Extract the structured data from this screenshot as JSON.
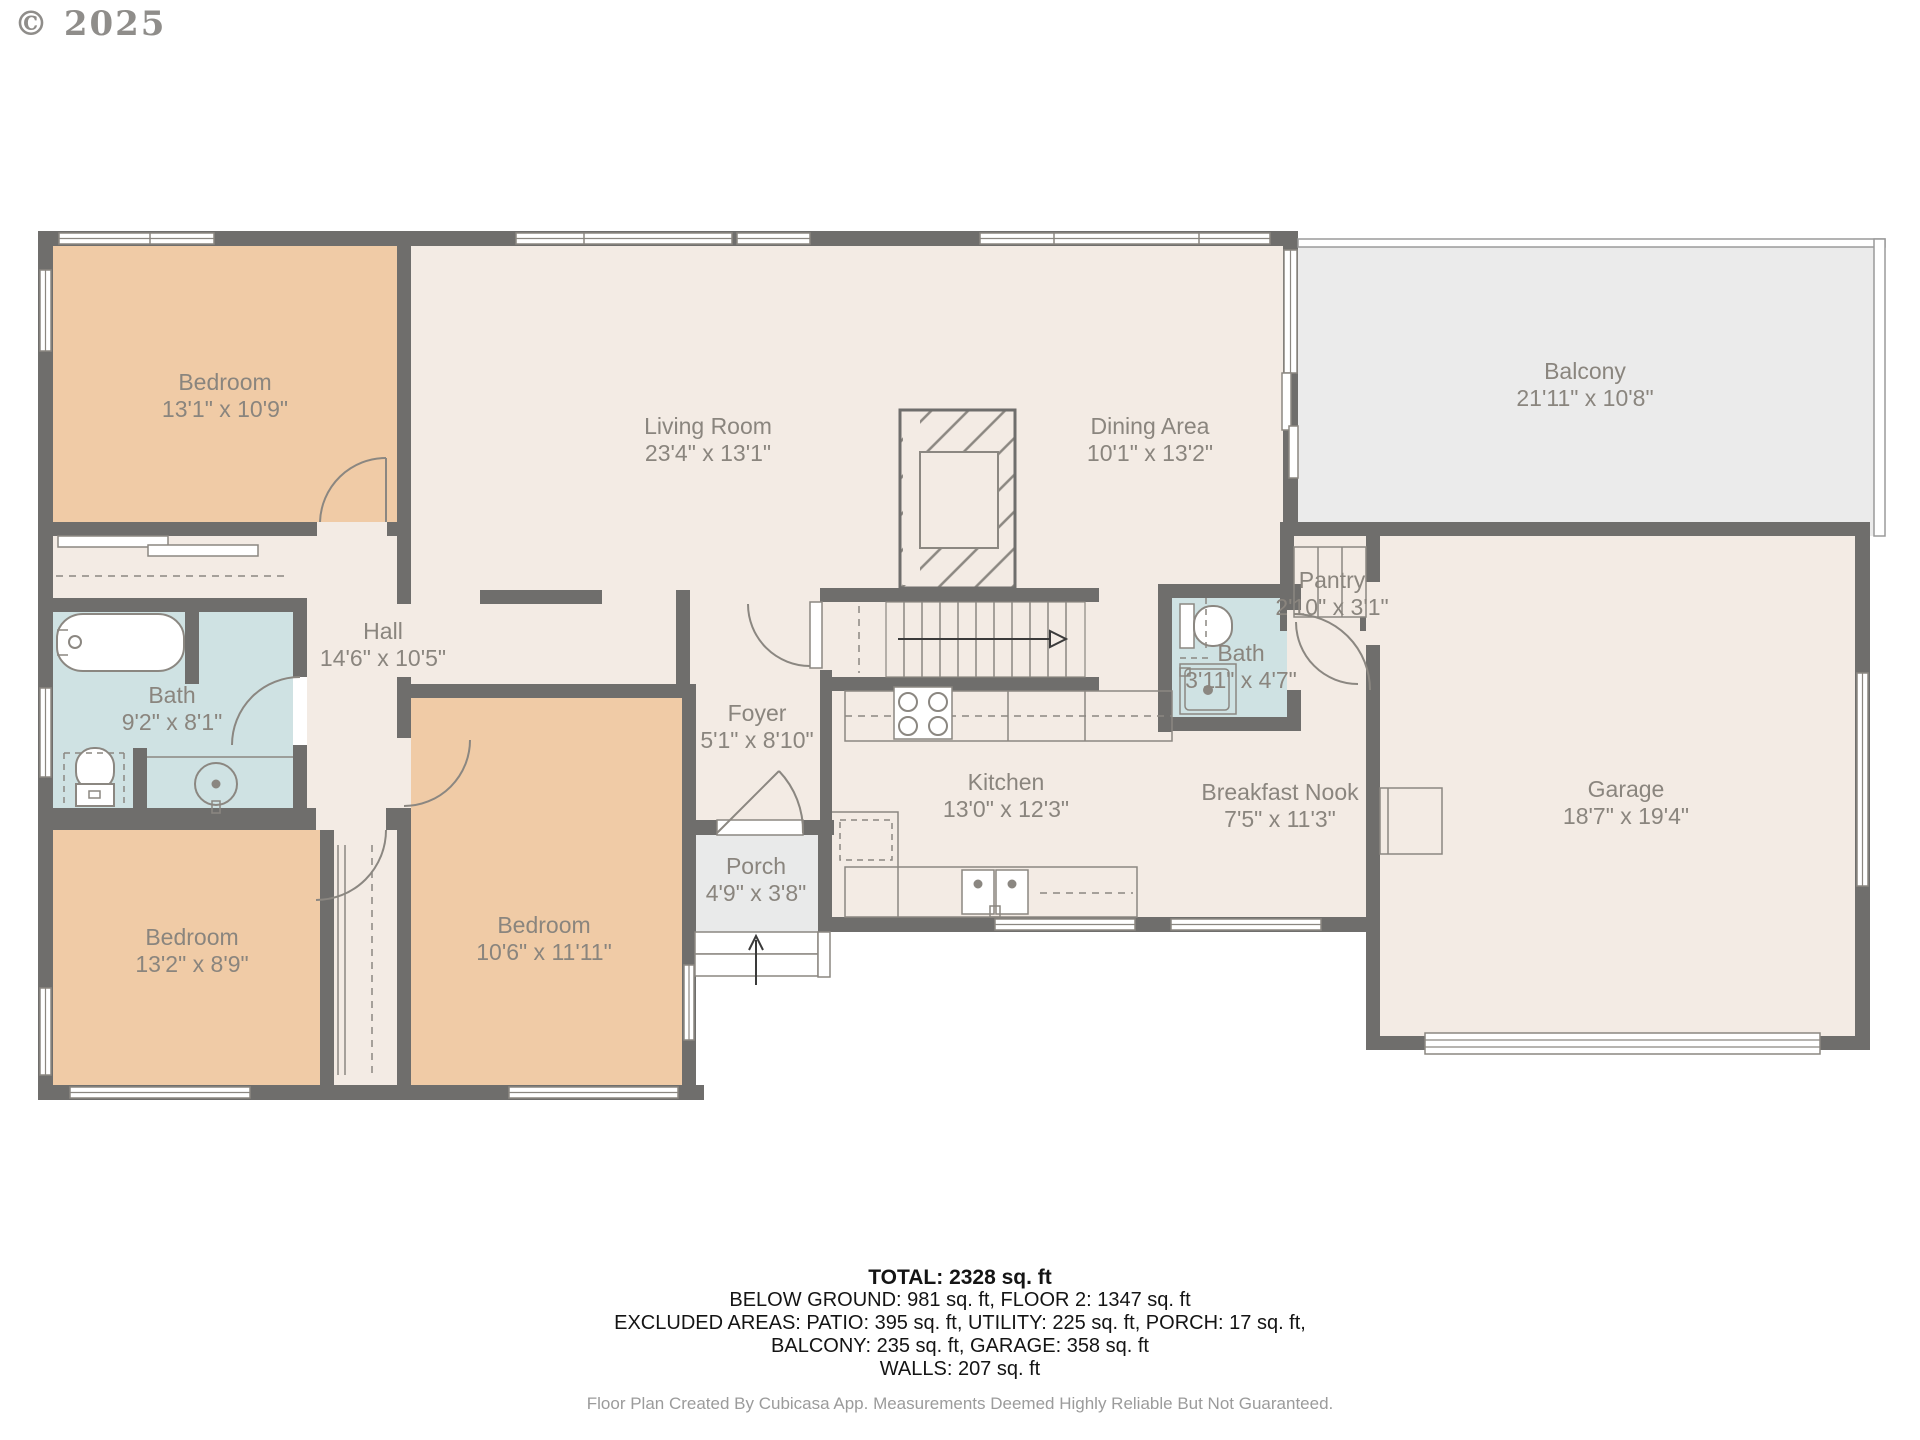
{
  "copyright": "© 2025",
  "rooms": [
    {
      "id": "bedroom-top-left",
      "name": "Bedroom",
      "dims": "13'1\" x 10'9\""
    },
    {
      "id": "living-room",
      "name": "Living Room",
      "dims": "23'4\" x 13'1\""
    },
    {
      "id": "dining-area",
      "name": "Dining Area",
      "dims": "10'1\" x 13'2\""
    },
    {
      "id": "balcony",
      "name": "Balcony",
      "dims": "21'11\" x 10'8\""
    },
    {
      "id": "hall",
      "name": "Hall",
      "dims": "14'6\" x 10'5\""
    },
    {
      "id": "bath-main",
      "name": "Bath",
      "dims": "9'2\" x 8'1\""
    },
    {
      "id": "pantry",
      "name": "Pantry",
      "dims": "2'10\" x 3'1\""
    },
    {
      "id": "bath-small",
      "name": "Bath",
      "dims": "3'11\" x 4'7\""
    },
    {
      "id": "foyer",
      "name": "Foyer",
      "dims": "5'1\" x 8'10\""
    },
    {
      "id": "kitchen",
      "name": "Kitchen",
      "dims": "13'0\" x 12'3\""
    },
    {
      "id": "breakfast-nook",
      "name": "Breakfast Nook",
      "dims": "7'5\" x 11'3\""
    },
    {
      "id": "garage",
      "name": "Garage",
      "dims": "18'7\" x 19'4\""
    },
    {
      "id": "porch",
      "name": "Porch",
      "dims": "4'9\" x 3'8\""
    },
    {
      "id": "bedroom-bottom-left",
      "name": "Bedroom",
      "dims": "13'2\" x 8'9\""
    },
    {
      "id": "bedroom-bottom-middle",
      "name": "Bedroom",
      "dims": "10'6\" x 11'11\""
    }
  ],
  "footer": {
    "total": "TOTAL: 2328 sq. ft",
    "line2": "BELOW GROUND: 981 sq. ft, FLOOR 2: 1347 sq. ft",
    "line3": "EXCLUDED AREAS: PATIO: 395 sq. ft, UTILITY: 225 sq. ft, PORCH: 17 sq. ft,",
    "line4": "BALCONY: 235 sq. ft, GARAGE: 358 sq. ft",
    "line5": "WALLS: 207 sq. ft",
    "disclaimer": "Floor Plan Created By Cubicasa App. Measurements Deemed Highly Reliable But Not Guaranteed."
  },
  "colors": {
    "wall": "#6f6e6c",
    "floor": "#f3ebe4",
    "bedroom": "#f0cba6",
    "bath": "#cfe2e3",
    "balcony": "#ebebeb",
    "porch": "#e9eaea",
    "fixture_line": "#8b8781",
    "label_text": "#8a857e"
  }
}
